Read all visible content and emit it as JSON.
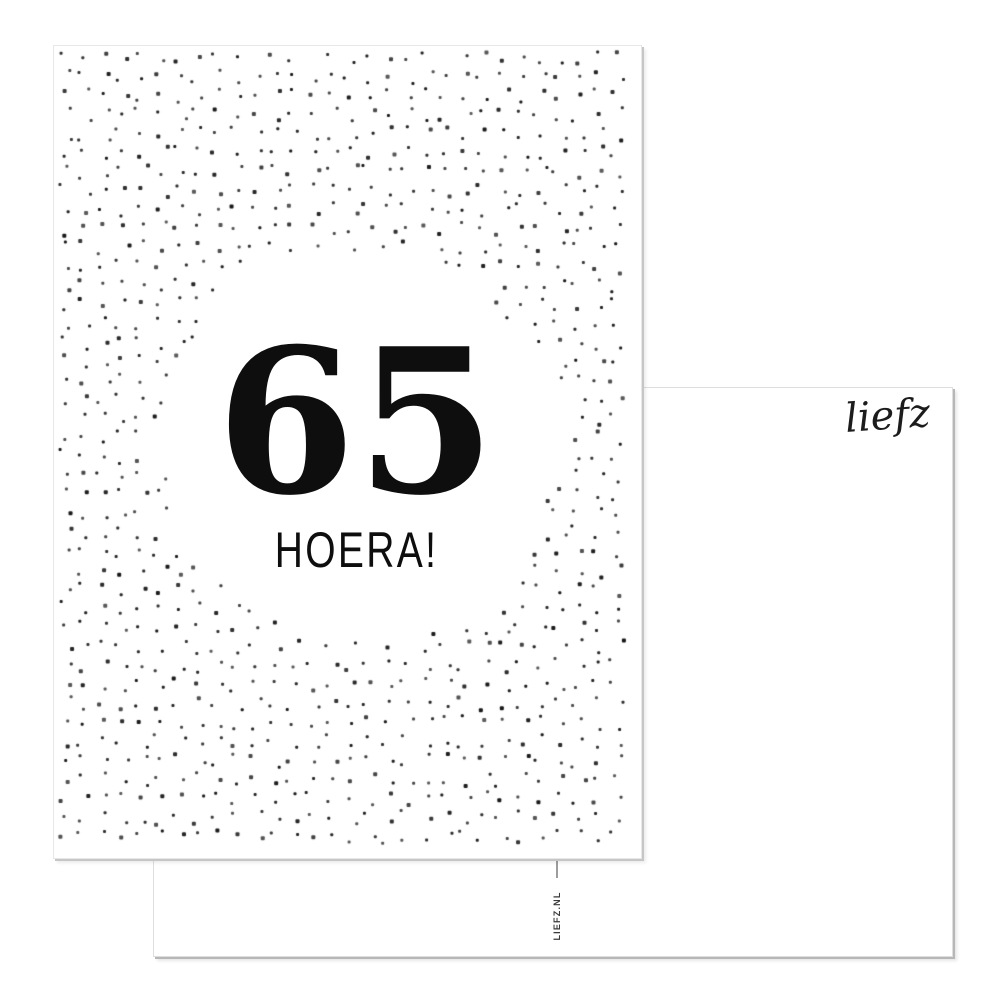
{
  "scene": {
    "background_color": "#ffffff"
  },
  "front_card": {
    "number": "65",
    "caption": "HOERA!",
    "ink_color": "#0e0e0e",
    "card_color": "#ffffff",
    "dot_pattern": {
      "dot_color": "#161616",
      "dot_size_px": 3,
      "grid_step_px": 19,
      "jitter_px": 7,
      "edge_margin_px": 10,
      "clear_circle": {
        "cx": 303,
        "cy": 399,
        "r": 190,
        "soft_edge_px": 26
      },
      "seed": 1337
    }
  },
  "back_card": {
    "brand_script": "liefz",
    "vertical_text": "LIEFZ.NL",
    "ink_color": "#1c1c1c",
    "card_color": "#ffffff",
    "edge_shadow_color": "#b7b7b7"
  }
}
